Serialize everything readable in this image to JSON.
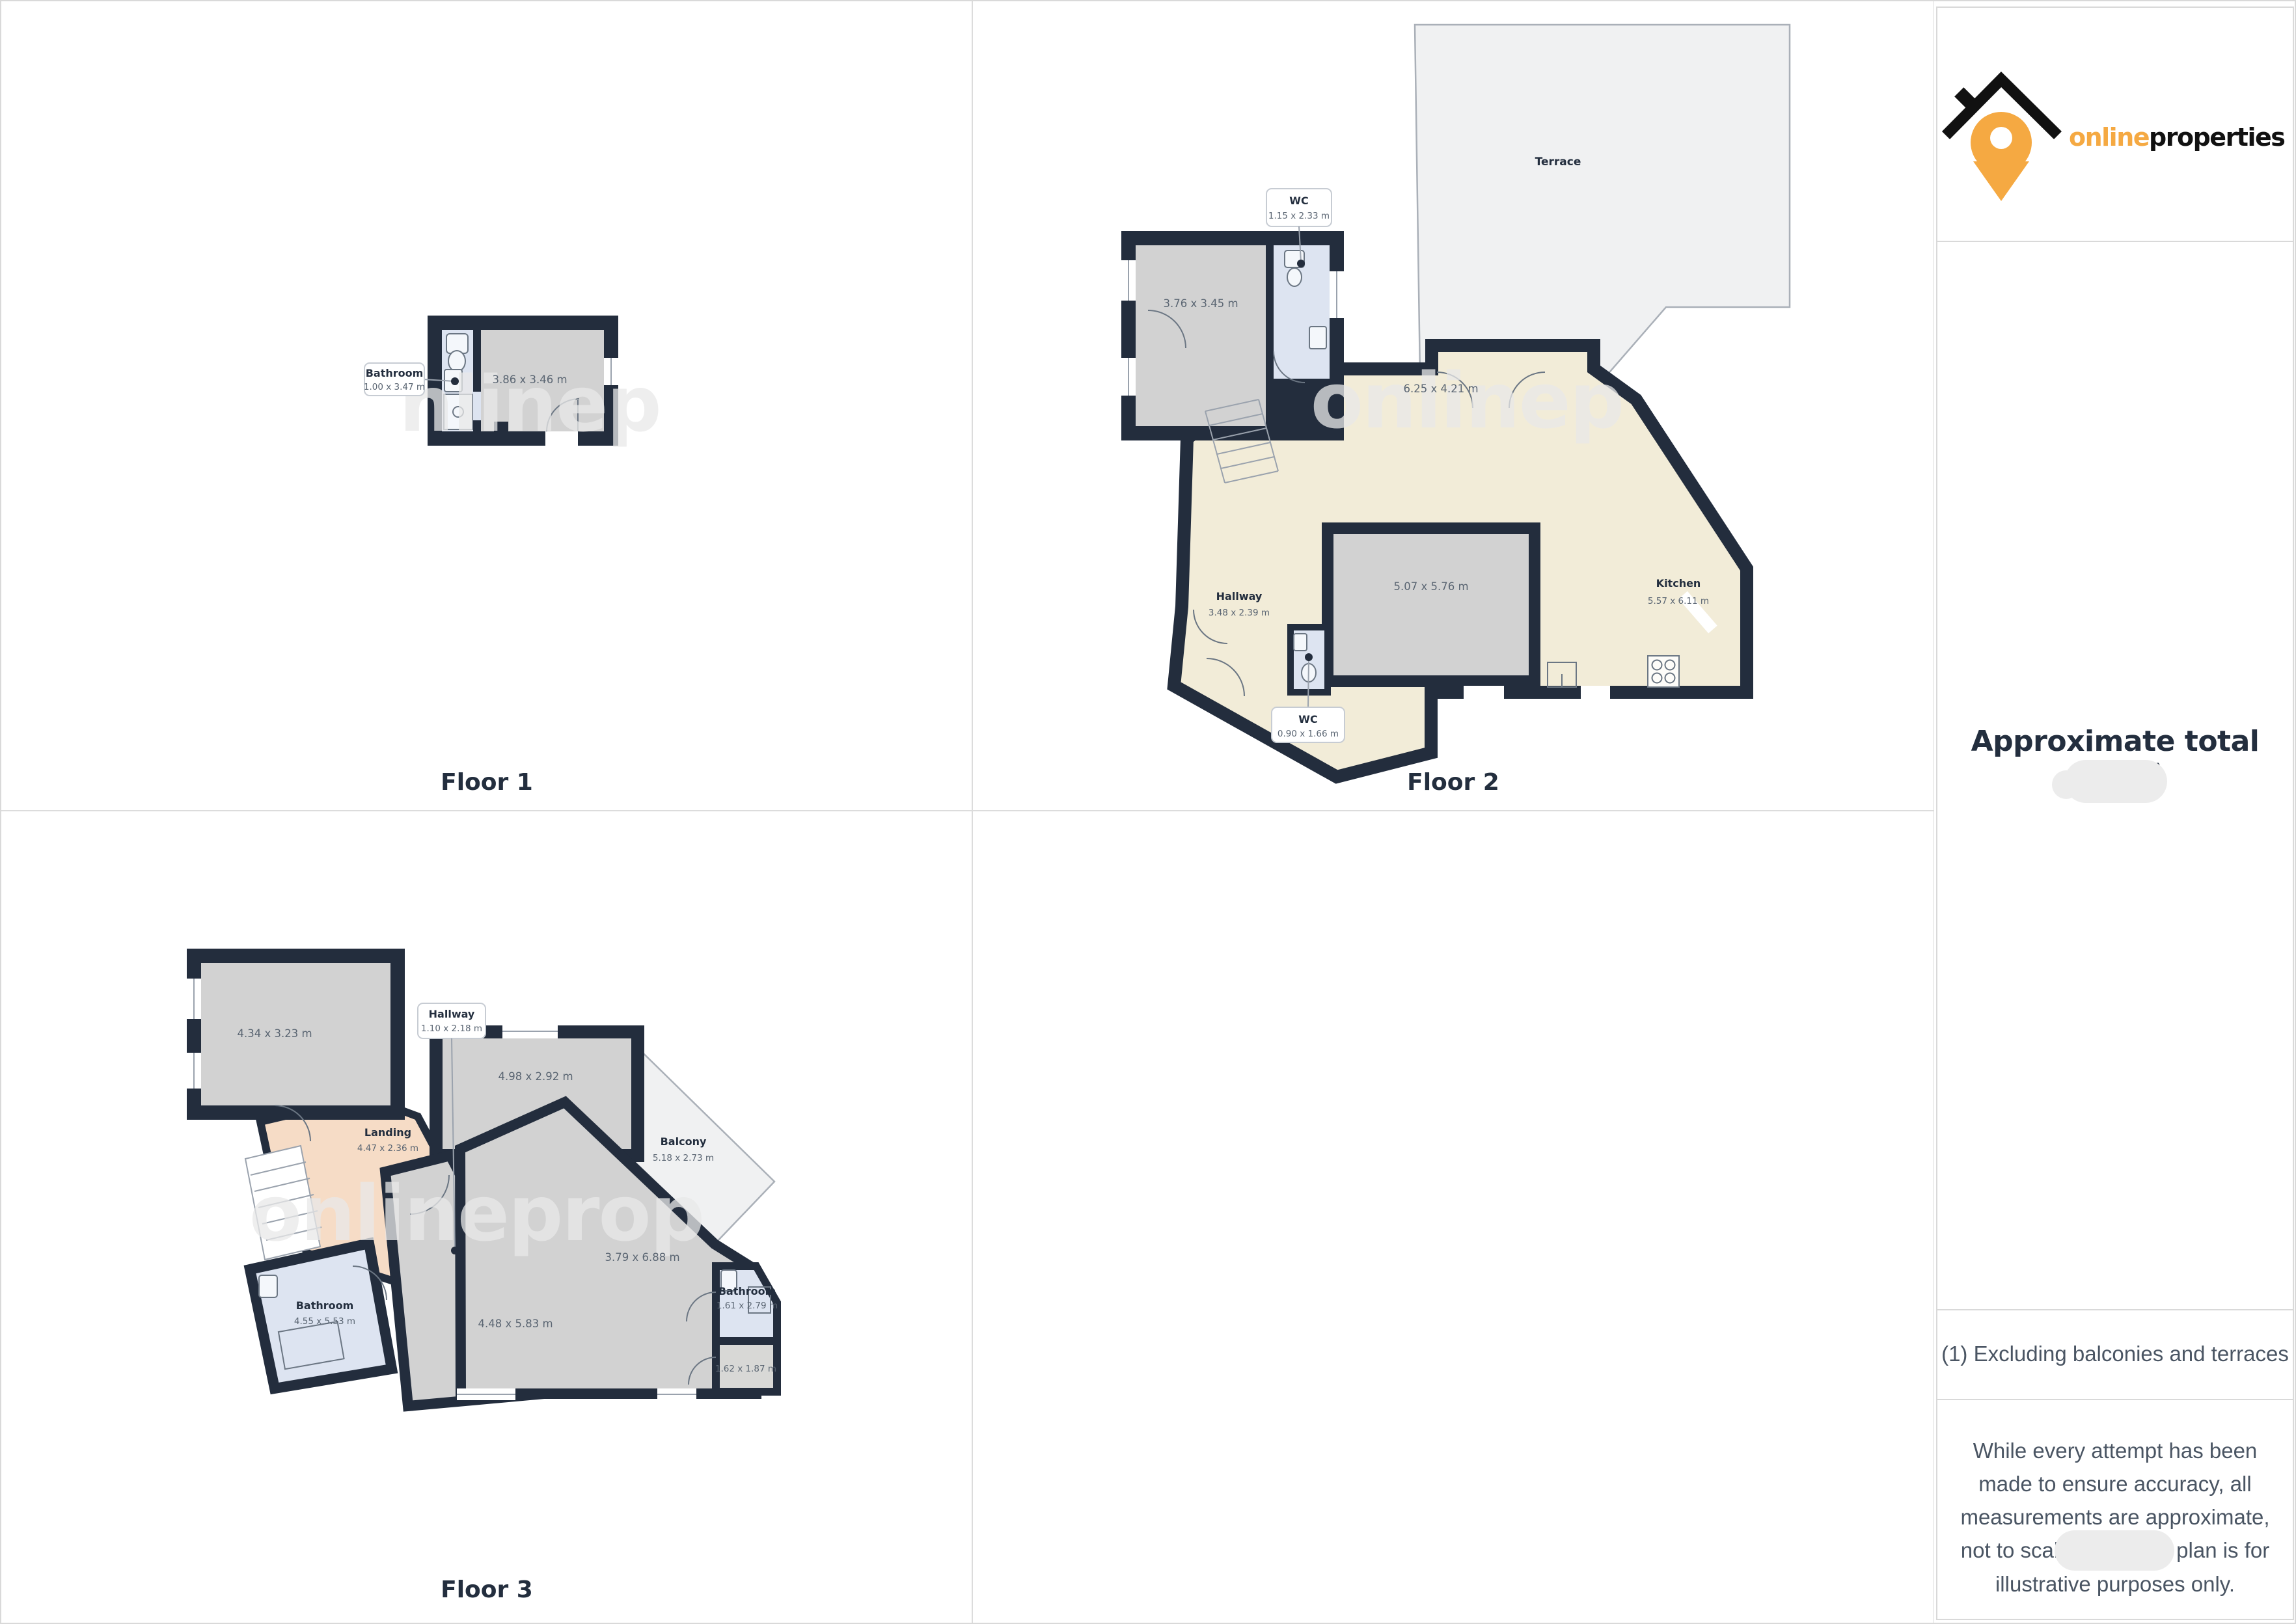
{
  "brand": {
    "word_primary": "online",
    "word_secondary": "properties",
    "accent_color": "#F5A942",
    "dark_color": "#232E3E"
  },
  "palette": {
    "wall": "#232D3D",
    "room_gray": "#D2D2D2",
    "room_blue": "#DDE4F1",
    "room_cream": "#F2ECD8",
    "room_salmon": "#F6DCC6",
    "outdoor_gray": "#F0F1F2",
    "text_dim": "#5A6572"
  },
  "floors": [
    {
      "label": "Floor 1",
      "watermark": "nlinep",
      "rooms": [
        {
          "name": "Bathroom",
          "dims": "1.00 x 3.47 m"
        },
        {
          "name": "",
          "dims": "3.86 x 3.46 m"
        }
      ]
    },
    {
      "label": "Floor 2",
      "watermark": "onlinep",
      "rooms": [
        {
          "name": "Terrace",
          "dims": ""
        },
        {
          "name": "WC",
          "dims": "1.15 x 2.33 m"
        },
        {
          "name": "",
          "dims": "3.76 x 3.45 m"
        },
        {
          "name": "",
          "dims": "6.25 x 4.21 m"
        },
        {
          "name": "Hallway",
          "dims": "3.48 x 2.39 m"
        },
        {
          "name": "",
          "dims": "5.07 x 5.76 m"
        },
        {
          "name": "Kitchen",
          "dims": "5.57 x 6.11 m"
        },
        {
          "name": "WC",
          "dims": "0.90 x 1.66 m"
        }
      ]
    },
    {
      "label": "Floor 3",
      "watermark": "onlineprop",
      "rooms": [
        {
          "name": "",
          "dims": "4.34 x 3.23 m"
        },
        {
          "name": "Hallway",
          "dims": "1.10 x 2.18 m"
        },
        {
          "name": "",
          "dims": "4.98 x 2.92 m"
        },
        {
          "name": "Landing",
          "dims": "4.47 x 2.36 m"
        },
        {
          "name": "Balcony",
          "dims": "5.18 x 2.73 m"
        },
        {
          "name": "Bathroom",
          "dims": "4.55 x 5.53 m"
        },
        {
          "name": "",
          "dims": "4.48 x 5.83 m"
        },
        {
          "name": "",
          "dims": "3.79 x 6.88 m"
        },
        {
          "name": "Bathroom",
          "dims": "1.61 x 2.79 m"
        },
        {
          "name": "",
          "dims": "1.62 x 1.87 m"
        }
      ]
    }
  ],
  "sidebar": {
    "total_area_heading": "Approximate total area",
    "footnote_marker": "(1)",
    "footnote": "(1) Excluding balconies and terraces",
    "disclaimer": "While every attempt has been made to ensure accuracy, all measurements are approximate, not to scale. This floor plan is for illustrative purposes only."
  }
}
